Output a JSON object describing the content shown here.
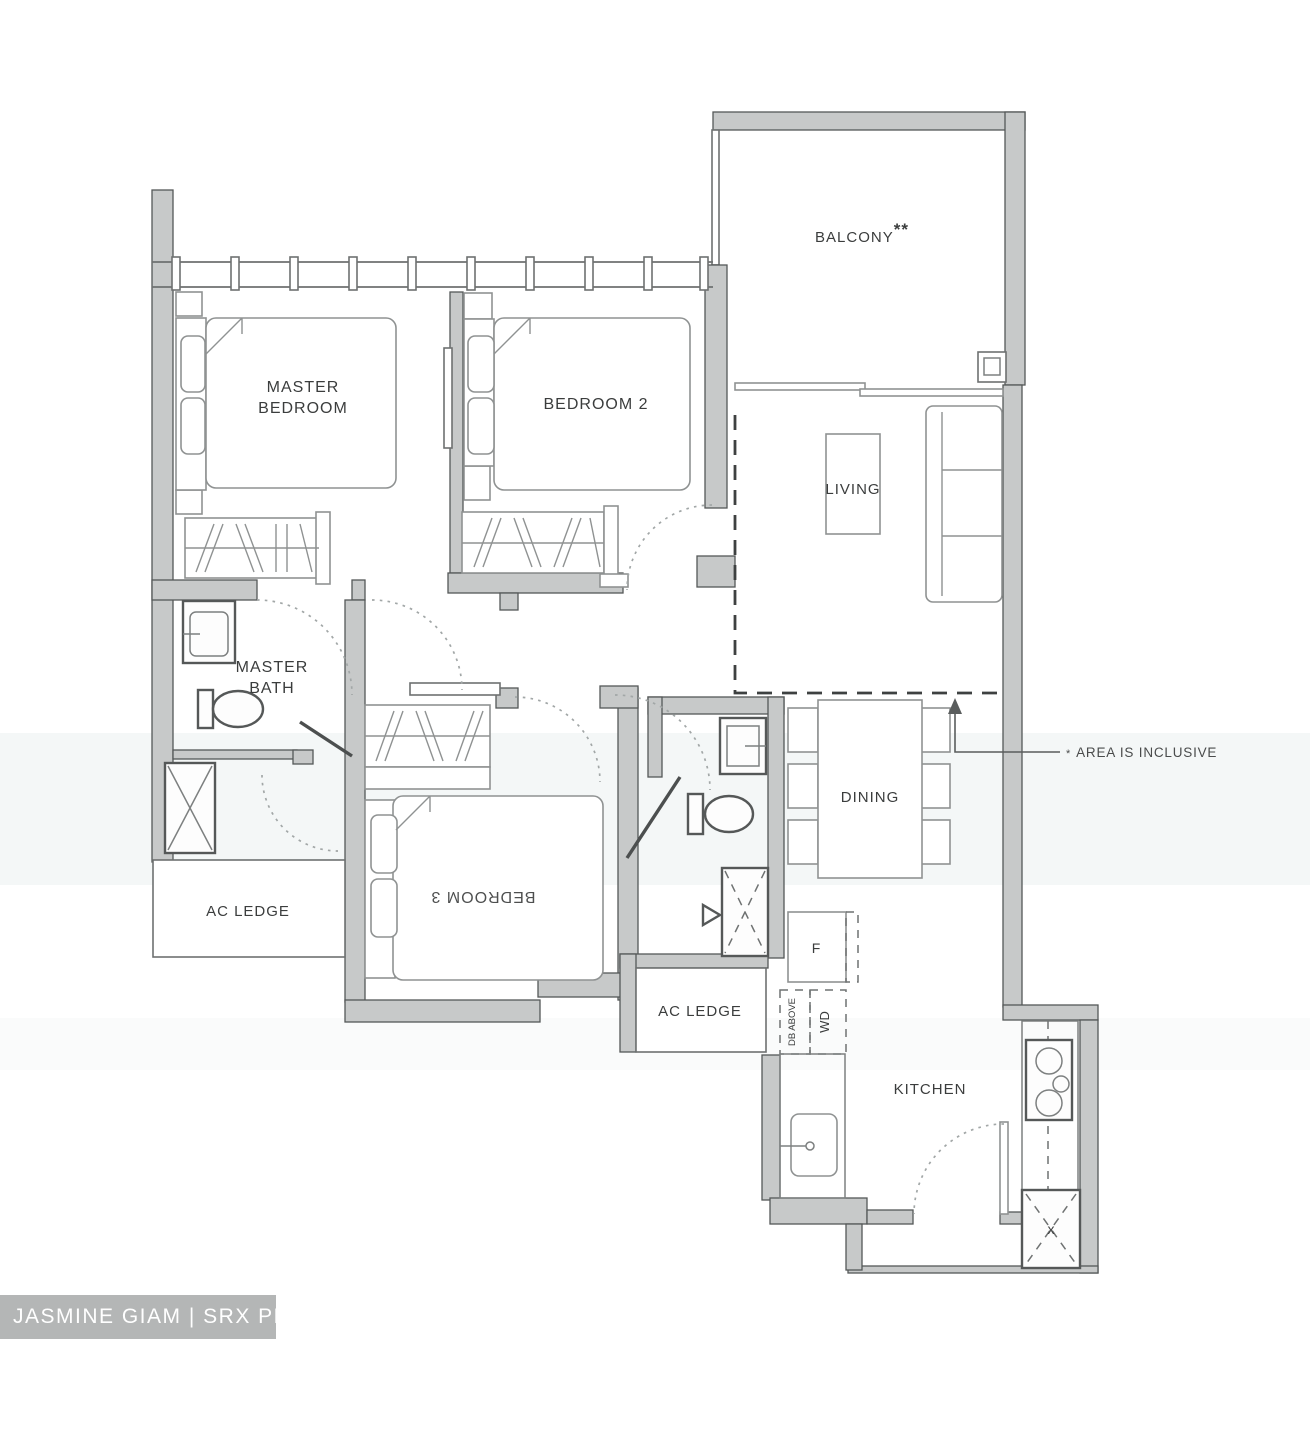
{
  "rooms": {
    "balcony": {
      "label": "BALCONY",
      "marker": "**"
    },
    "master_bedroom": {
      "line1": "MASTER",
      "line2": "BEDROOM"
    },
    "bedroom2": {
      "label": "BEDROOM 2"
    },
    "bedroom3": {
      "label": "BEDROOM 3"
    },
    "living": {
      "label": "LIVING"
    },
    "dining": {
      "label": "DINING"
    },
    "master_bath": {
      "line1": "MASTER",
      "line2": "BATH"
    },
    "kitchen": {
      "label": "KITCHEN"
    },
    "ac_ledge_left": {
      "label": "AC LEDGE"
    },
    "ac_ledge_mid": {
      "label": "AC LEDGE"
    }
  },
  "appliances": {
    "fridge": "F",
    "washer_dryer": "WD",
    "db_above": "DB ABOVE",
    "floor_trap": "x"
  },
  "annotation": {
    "note_marker": "*",
    "area_note": "AREA IS INCLUSIVE"
  },
  "watermark": {
    "label": "JASMINE GIAM | SRX PROPERTY"
  },
  "colors": {
    "wall_fill": "#c7c9c9",
    "wall_line": "#555858",
    "label_text": "#3b3d3d",
    "watermark_bg": "#b4b6b6",
    "watermark_text": "#ffffff"
  }
}
